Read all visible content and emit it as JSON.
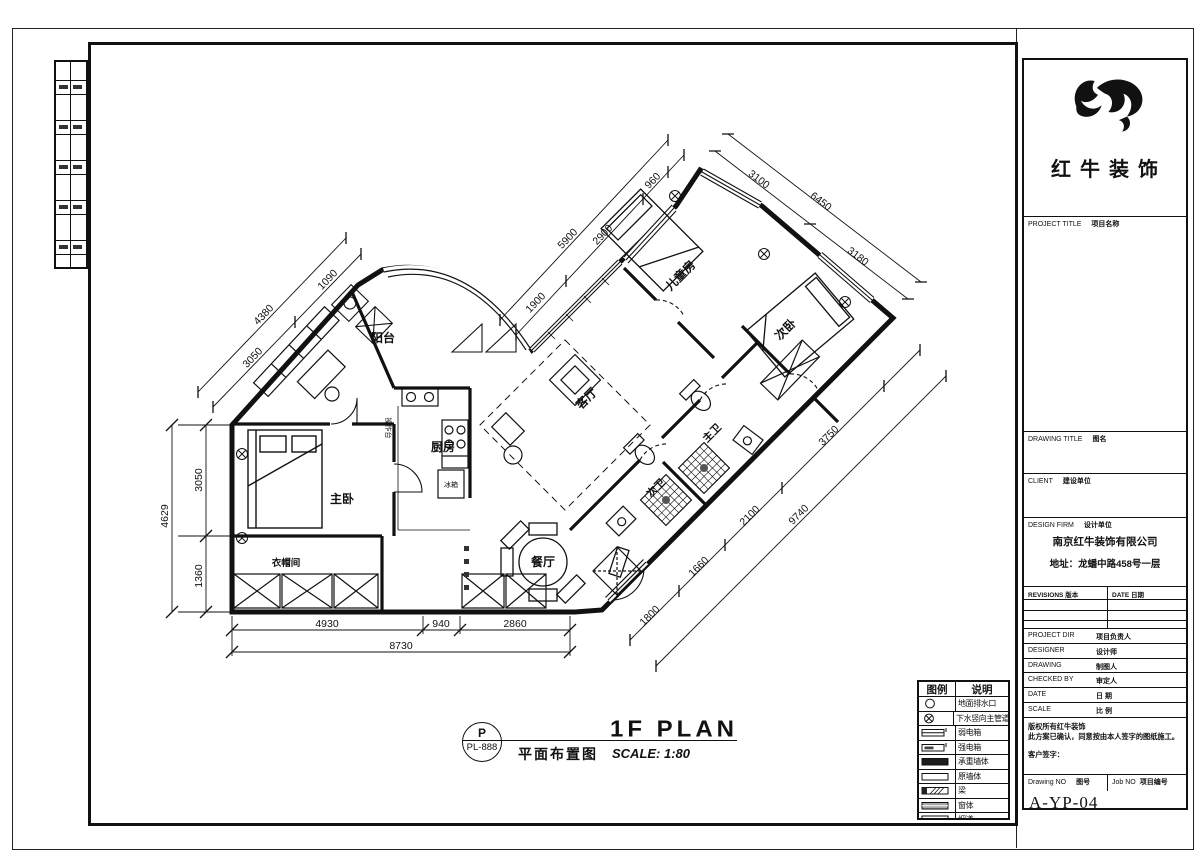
{
  "branding": {
    "company_name": "红牛装饰"
  },
  "title_block": {
    "project_title_en": "PROJECT TITLE",
    "project_title_cn": "项目名称",
    "drawing_title_en": "DRAWING TITLE",
    "drawing_title_cn": "图名",
    "client_en": "CLIENT",
    "client_cn": "建设单位",
    "design_firm_en": "DESIGN FIRM",
    "design_firm_cn": "设计单位",
    "firm_name": "南京红牛装饰有限公司",
    "firm_address": "地址：龙蟠中路458号一层",
    "revisions_en": "REVISIONS",
    "revisions_cn": "版本",
    "rev_date_en": "DATE",
    "rev_date_cn": "日期",
    "project_dir_en": "PROJECT DIR",
    "project_dir_cn": "项目负责人",
    "designer_en": "DESIGNER",
    "designer_cn": "设计师",
    "drawing_by_en": "DRAWING",
    "drawing_by_cn": "制图人",
    "checked_by_en": "CHECKED BY",
    "checked_by_cn": "审定人",
    "date_en": "DATE",
    "date_cn": "日 期",
    "scale_en": "SCALE",
    "scale_cn": "比 例",
    "note1": "版权所有红牛装饰",
    "note2": "此方案已确认，同意按由本人签字的图纸施工。",
    "note3": "客户签字：",
    "drawing_no_en": "Drawing NO",
    "drawing_no_cn": "图号",
    "job_no_en": "Job NO",
    "job_no_cn": "项目编号",
    "drawing_no": "A-YP-04"
  },
  "legend": {
    "header_symbol": "图例",
    "header_desc": "说明",
    "items": [
      {
        "icon": "floor-drain-icon",
        "label": "地面排水口"
      },
      {
        "icon": "main-drain-pipe-icon",
        "label": "下水竖向主管道"
      },
      {
        "icon": "weak-current-box-icon",
        "label": "弱电箱"
      },
      {
        "icon": "strong-current-box-icon",
        "label": "强电箱"
      },
      {
        "icon": "load-bearing-wall-icon",
        "label": "承重墙体"
      },
      {
        "icon": "original-wall-icon",
        "label": "原墙体"
      },
      {
        "icon": "beam-icon",
        "label": "梁"
      },
      {
        "icon": "window-icon",
        "label": "窗体"
      },
      {
        "icon": "flue-icon",
        "label": "烟道"
      },
      {
        "icon": "gas-pipe-icon",
        "label": "燃气管道"
      }
    ]
  },
  "footer": {
    "ref_top": "P",
    "ref_bottom": "PL-888",
    "title_en": "1F PLAN",
    "title_cn": "平面布置图",
    "scale_text": "SCALE: 1:80"
  },
  "plan": {
    "rooms": [
      {
        "name": "balcony",
        "label": "阳台"
      },
      {
        "name": "kitchen",
        "label": "厨房"
      },
      {
        "name": "master-bedroom",
        "label": "主卧"
      },
      {
        "name": "cloakroom",
        "label": "衣帽间"
      },
      {
        "name": "dining-room",
        "label": "餐厅"
      },
      {
        "name": "living-room",
        "label": "客厅"
      },
      {
        "name": "kids-room",
        "label": "儿童房"
      },
      {
        "name": "second-bedroom",
        "label": "次卧"
      },
      {
        "name": "master-bath",
        "label": "主卫"
      },
      {
        "name": "second-bath",
        "label": "次卫"
      }
    ],
    "fixtures": [
      {
        "name": "counter",
        "label": "操作台"
      },
      {
        "name": "fridge",
        "label": "冰箱"
      }
    ],
    "dimensions": {
      "bottom": [
        "4930",
        "940",
        "2860"
      ],
      "bottom_total": "8730",
      "left": [
        "3050",
        "1360"
      ],
      "left_total": "4629",
      "nw": [
        "3050",
        "1090"
      ],
      "nw_total": "4380",
      "top": [
        "1900",
        "2900",
        "960"
      ],
      "top_total": "5900",
      "ne": [
        "3100",
        "3180"
      ],
      "ne_total": "6450",
      "se": [
        "1800",
        "1660",
        "2100",
        "3750"
      ],
      "se_total": "9740"
    }
  }
}
